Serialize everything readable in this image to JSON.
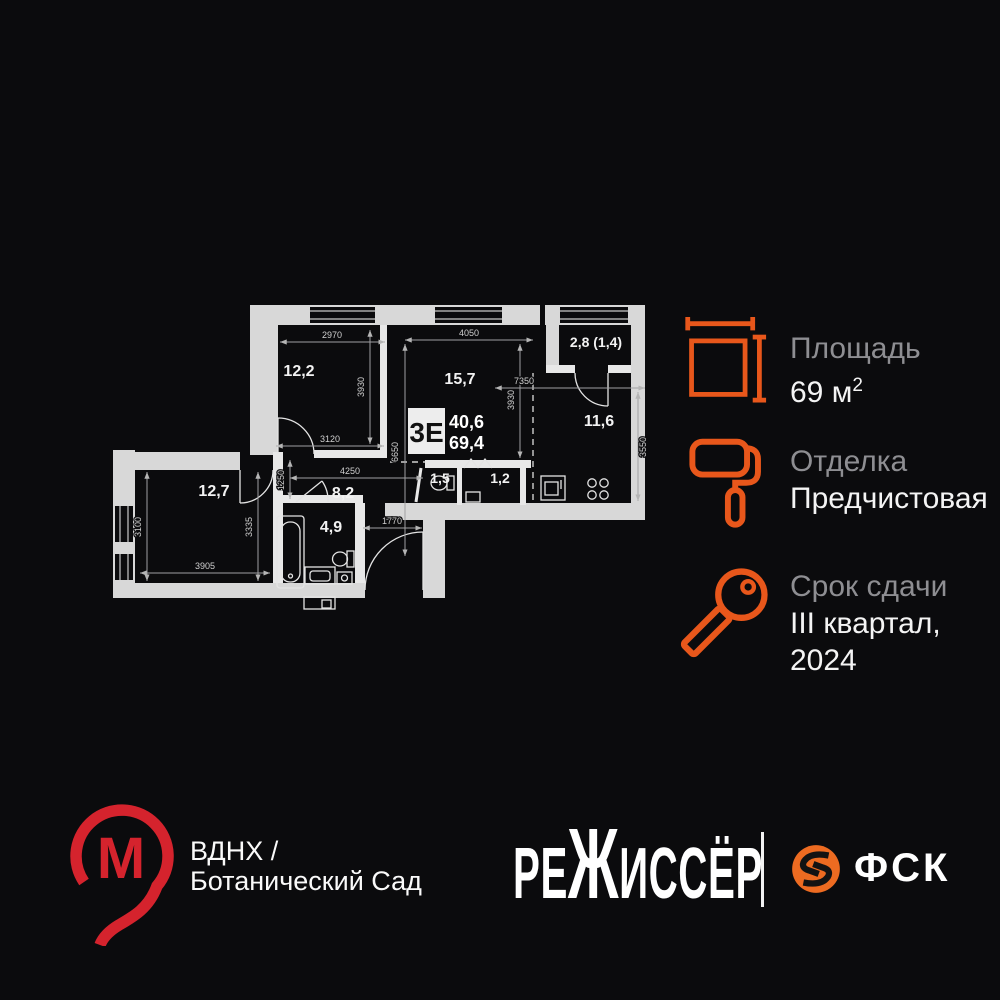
{
  "colors": {
    "background": "#0b0b0d",
    "wall_gray": "#d8d8d8",
    "accent_orange": "#e8571b",
    "fsk_orange": "#ed6b21",
    "metro_red": "#d5232d"
  },
  "plan": {
    "badge": {
      "type": "3Е",
      "upper": "40,6",
      "lower": "69,4"
    },
    "rooms": [
      {
        "id": "room-12-2",
        "area": "12,2"
      },
      {
        "id": "room-15-7",
        "area": "15,7"
      },
      {
        "id": "balcony",
        "area": "2,8 (1,4)"
      },
      {
        "id": "kitchen",
        "area": "11,6"
      },
      {
        "id": "wc",
        "area": "1,5"
      },
      {
        "id": "storage",
        "area": "1,2"
      },
      {
        "id": "hall",
        "area": "8,2"
      },
      {
        "id": "bathroom",
        "area": "4,9"
      },
      {
        "id": "room-12-7",
        "area": "12,7"
      }
    ],
    "dims": [
      "2970",
      "3930",
      "3120",
      "4050",
      "3930",
      "6650",
      "7350",
      "3550",
      "4250",
      "1250",
      "1770",
      "3100",
      "3905",
      "3335"
    ]
  },
  "specs": [
    {
      "icon": "area-icon",
      "label": "Площадь",
      "value": "69 м",
      "value_sup": "2"
    },
    {
      "icon": "paint-roller-icon",
      "label": "Отделка",
      "value": "Предчистовая"
    },
    {
      "icon": "key-icon",
      "label": "Срок сдачи",
      "value": "III квартал,",
      "value2": "2024"
    }
  ],
  "footer": {
    "metro_letter": "М",
    "station_line1": "ВДНХ /",
    "station_line2": "Ботанический Сад",
    "developer": {
      "full": "РЕЖИССЁР",
      "pre": "РЕ",
      "zh": "Ж",
      "post": "ИССЁР"
    },
    "brand": "ФСК"
  }
}
